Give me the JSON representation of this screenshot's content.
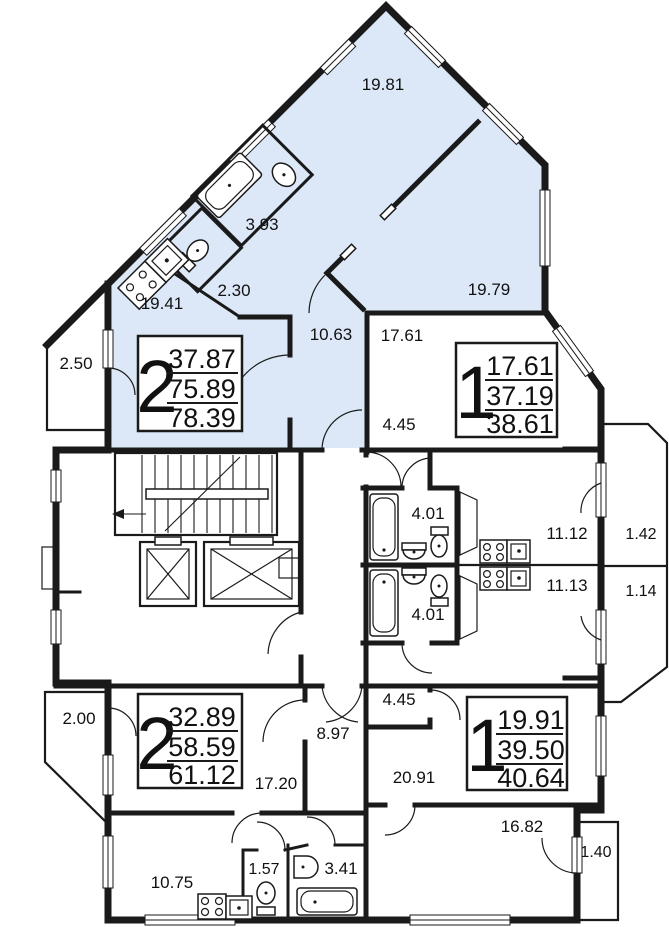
{
  "colors": {
    "highlight_apartment_fill": "#dce8f8",
    "walls": "#1a1a1a",
    "background": "#ffffff"
  },
  "labels": [
    {
      "t": "19.81"
    },
    {
      "t": "3.93"
    },
    {
      "t": "2.30"
    },
    {
      "t": "19.41"
    },
    {
      "t": "19.79"
    },
    {
      "t": "10.63"
    },
    {
      "t": "17.61"
    },
    {
      "t": "2.50"
    },
    {
      "t": "4.45"
    },
    {
      "t": "4.01"
    },
    {
      "t": "4.01"
    },
    {
      "t": "11.12"
    },
    {
      "t": "1.42"
    },
    {
      "t": "11.13"
    },
    {
      "t": "1.14"
    },
    {
      "t": "2.00"
    },
    {
      "t": "4.45"
    },
    {
      "t": "8.97"
    },
    {
      "t": "17.20"
    },
    {
      "t": "20.91"
    },
    {
      "t": "10.75"
    },
    {
      "t": "1.57"
    },
    {
      "t": "3.41"
    },
    {
      "t": "16.82"
    },
    {
      "t": "1.40"
    }
  ],
  "apartments": [
    {
      "rooms": "2",
      "living": "37.87",
      "area": "75.89",
      "total": "78.39"
    },
    {
      "rooms": "1",
      "living": "17.61",
      "area": "37.19",
      "total": "38.61"
    },
    {
      "rooms": "2",
      "living": "32.89",
      "area": "58.59",
      "total": "61.12"
    },
    {
      "rooms": "1",
      "living": "19.91",
      "area": "39.50",
      "total": "40.64"
    }
  ],
  "fixtures": {
    "bathtub": "bathtub-icon",
    "toilet": "toilet-icon",
    "sink": "sink-icon",
    "stove": "stove-icon",
    "elevator": "elevator-icon",
    "stairs": "stairs-icon"
  }
}
